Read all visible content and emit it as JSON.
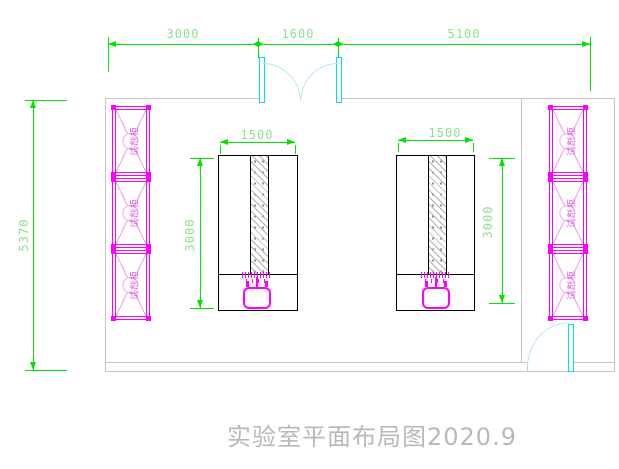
{
  "title": {
    "text": "实验室平面布局图2020.9"
  },
  "dimensions": {
    "top": {
      "segments": [
        "3000",
        "1600",
        "5100"
      ]
    },
    "left": {
      "overall": "5370"
    },
    "bench_left": {
      "width": "1500",
      "depth": "3000"
    },
    "bench_right": {
      "width": "1500",
      "depth": "3000"
    }
  },
  "cabinets": {
    "label": "试剂柜",
    "left_column_count": 3,
    "right_column_count": 3
  },
  "colors": {
    "dimension_line": "#00e400",
    "dimension_text": "#8fe08f",
    "cabinet_outline": "#ff00ff",
    "cabinet_detail": "#f2a8f2",
    "cabinet_text": "#dd55dd",
    "door": "#00e0e0",
    "door_arc": "#b5ebeb",
    "wall": "#c6c6c6",
    "bench_outline": "#000000",
    "title_text": "#b9b9b9"
  }
}
